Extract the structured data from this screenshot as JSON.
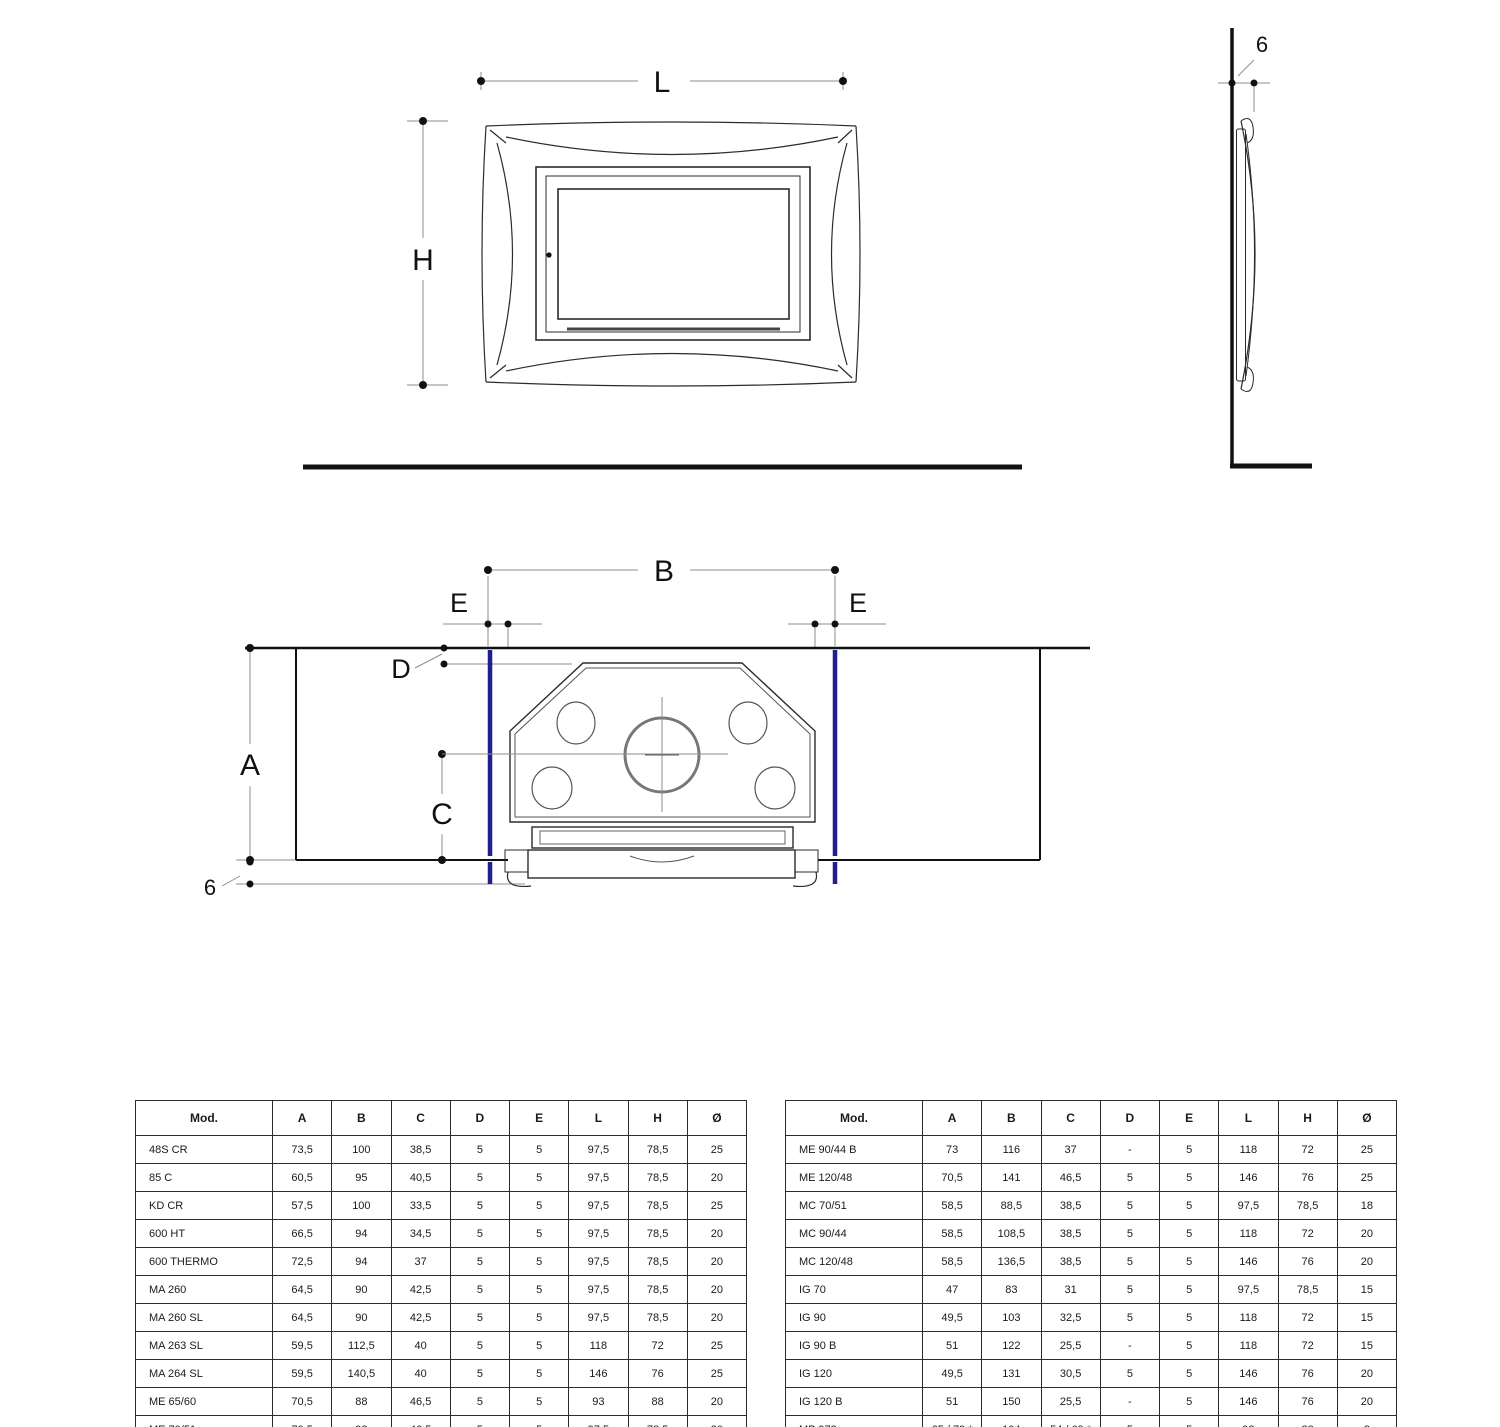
{
  "page": {
    "background": "#ffffff"
  },
  "drawings": {
    "accent_blue": "#1f1f8f",
    "line_color": "#2b2b2b",
    "front_view": {
      "labels": {
        "width": "L",
        "height": "H"
      }
    },
    "side_view": {
      "labels": {
        "wall_offset": "6"
      }
    },
    "section_view": {
      "labels": {
        "inner_width": "B",
        "side_gap_left": "E",
        "side_gap_right": "E",
        "top_gap": "D",
        "inner_height": "A",
        "flue_center_height": "C",
        "bottom_offset": "6"
      }
    }
  },
  "tables": {
    "columns": [
      "Mod.",
      "A",
      "B",
      "C",
      "D",
      "E",
      "L",
      "H",
      "Ø"
    ],
    "left": {
      "rows": [
        [
          "48S CR",
          "73,5",
          "100",
          "38,5",
          "5",
          "5",
          "97,5",
          "78,5",
          "25"
        ],
        [
          "85 C",
          "60,5",
          "95",
          "40,5",
          "5",
          "5",
          "97,5",
          "78,5",
          "20"
        ],
        [
          "KD CR",
          "57,5",
          "100",
          "33,5",
          "5",
          "5",
          "97,5",
          "78,5",
          "25"
        ],
        [
          "600 HT",
          "66,5",
          "94",
          "34,5",
          "5",
          "5",
          "97,5",
          "78,5",
          "20"
        ],
        [
          "600 THERMO",
          "72,5",
          "94",
          "37",
          "5",
          "5",
          "97,5",
          "78,5",
          "20"
        ],
        [
          "MA 260",
          "64,5",
          "90",
          "42,5",
          "5",
          "5",
          "97,5",
          "78,5",
          "20"
        ],
        [
          "MA 260 SL",
          "64,5",
          "90",
          "42,5",
          "5",
          "5",
          "97,5",
          "78,5",
          "20"
        ],
        [
          "MA 263 SL",
          "59,5",
          "112,5",
          "40",
          "5",
          "5",
          "118",
          "72",
          "25"
        ],
        [
          "MA 264 SL",
          "59,5",
          "140,5",
          "40",
          "5",
          "5",
          "146",
          "76",
          "25"
        ],
        [
          "ME 65/60",
          "70,5",
          "88",
          "46,5",
          "5",
          "5",
          "93",
          "88",
          "20"
        ],
        [
          "ME 70/51",
          "70,5",
          "92",
          "46,5",
          "5",
          "5",
          "97,5",
          "78,5",
          "20"
        ]
      ]
    },
    "right": {
      "rows": [
        [
          "ME 90/44 B",
          "73",
          "116",
          "37",
          "-",
          "5",
          "118",
          "72",
          "25"
        ],
        [
          "ME 120/48",
          "70,5",
          "141",
          "46,5",
          "5",
          "5",
          "146",
          "76",
          "25"
        ],
        [
          "MC 70/51",
          "58,5",
          "88,5",
          "38,5",
          "5",
          "5",
          "97,5",
          "78,5",
          "18"
        ],
        [
          "MC 90/44",
          "58,5",
          "108,5",
          "38,5",
          "5",
          "5",
          "118",
          "72",
          "20"
        ],
        [
          "MC 120/48",
          "58,5",
          "136,5",
          "38,5",
          "5",
          "5",
          "146",
          "76",
          "20"
        ],
        [
          "IG 70",
          "47",
          "83",
          "31",
          "5",
          "5",
          "97,5",
          "78,5",
          "15"
        ],
        [
          "IG 90",
          "49,5",
          "103",
          "32,5",
          "5",
          "5",
          "118",
          "72",
          "15"
        ],
        [
          "IG 90 B",
          "51",
          "122",
          "25,5",
          "-",
          "5",
          "118",
          "72",
          "15"
        ],
        [
          "IG 120",
          "49,5",
          "131",
          "30,5",
          "5",
          "5",
          "146",
          "76",
          "20"
        ],
        [
          "IG 120 B",
          "51",
          "150",
          "25,5",
          "-",
          "5",
          "146",
          "76",
          "20"
        ],
        [
          "MP 973",
          "65 / 79 *",
          "104",
          "54 / 69 *",
          "5",
          "5",
          "93",
          "88",
          "8"
        ]
      ]
    }
  }
}
